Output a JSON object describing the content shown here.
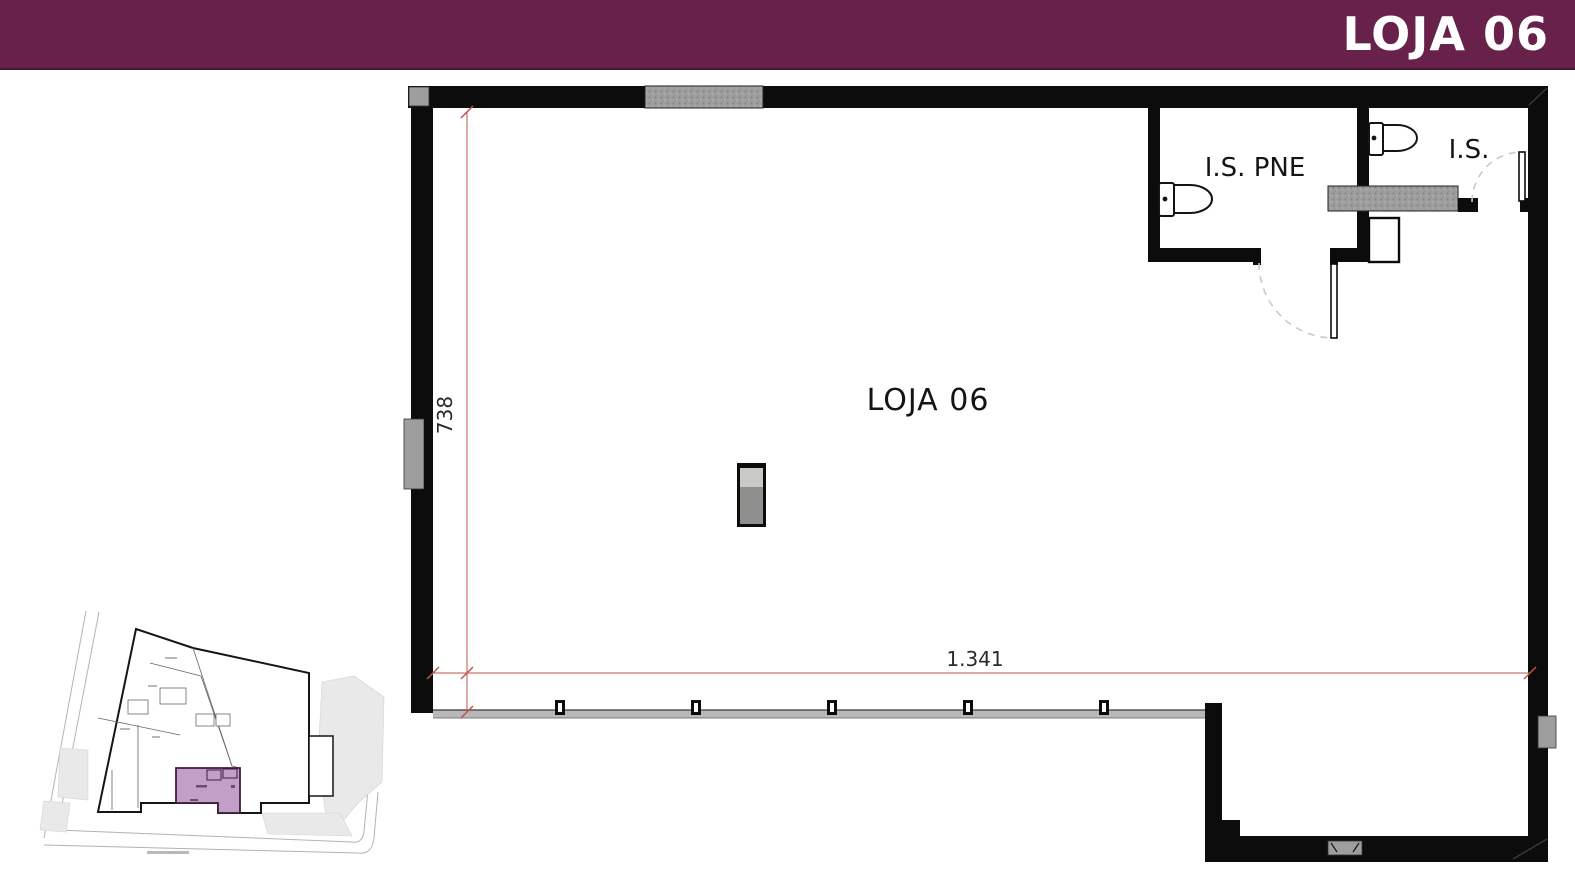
{
  "header": {
    "title": "LOJA 06"
  },
  "floor_plan": {
    "unit_label": "LOJA 06",
    "accessible_wc_label": "I.S. PNE",
    "wc_label": "I.S.",
    "height_dimension": "738",
    "width_dimension": "1.341"
  },
  "colors": {
    "header_bg": "#67214b",
    "header_text": "#ffffff",
    "wall": "#0c0c0c",
    "fixture_gray": "#9e9e9e",
    "dimension_red": "#bf544a",
    "keyplan_highlight": "#c29fc7",
    "keyplan_highlight_border": "#3f1d3b"
  }
}
